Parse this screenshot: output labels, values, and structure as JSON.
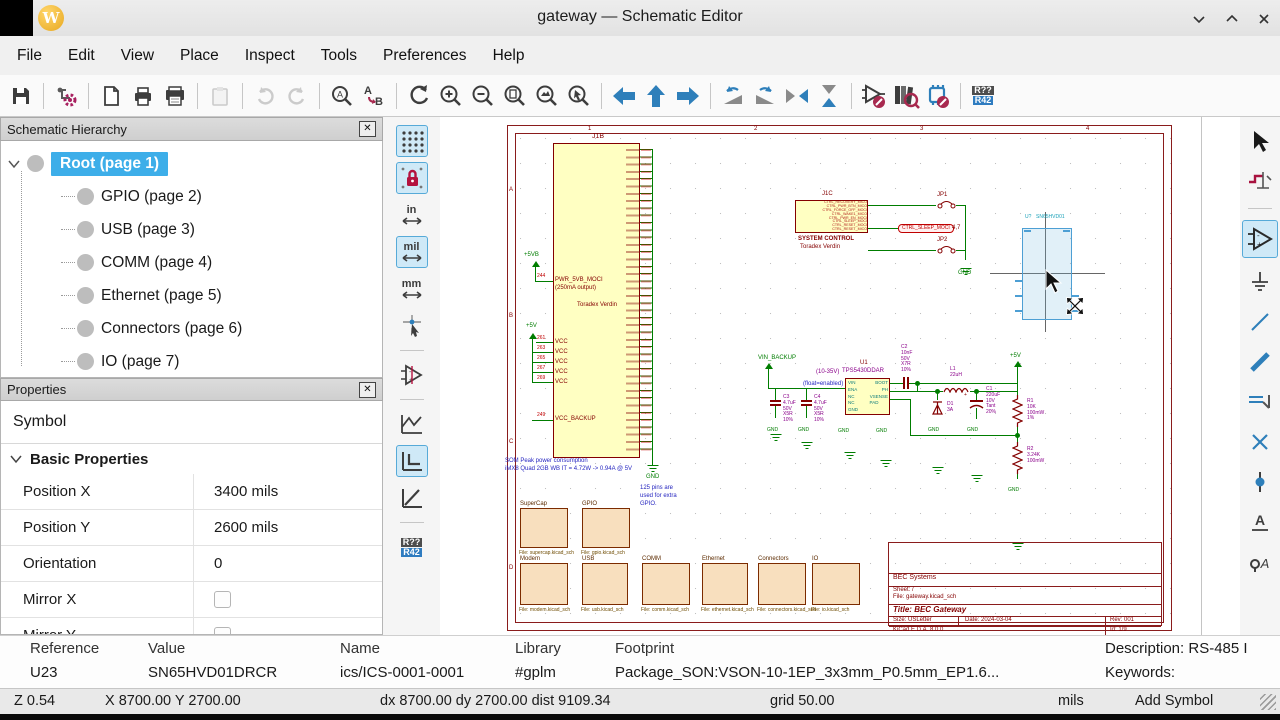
{
  "window": {
    "title": "gateway — Schematic Editor",
    "controls": [
      "chevron-down",
      "chevron-up",
      "close"
    ]
  },
  "menu": {
    "items": [
      "File",
      "Edit",
      "View",
      "Place",
      "Inspect",
      "Tools",
      "Preferences",
      "Help"
    ]
  },
  "toolbar_icons": [
    "save",
    "schematic-setup",
    "page-settings",
    "print",
    "plot",
    "paste",
    "undo",
    "redo",
    "find",
    "find-replace",
    "refresh-view",
    "zoom-in",
    "zoom-out",
    "zoom-fit",
    "zoom-objects",
    "zoom-selection",
    "nav-back",
    "nav-up",
    "nav-forward",
    "rotate-ccw",
    "rotate-cw",
    "mirror-horizontal",
    "mirror-vertical",
    "edit-symbol",
    "browse-libraries",
    "edit-footprint",
    "annotate"
  ],
  "annotate_icon": {
    "from": "R??",
    "to": "R42"
  },
  "hierarchy": {
    "title": "Schematic Hierarchy",
    "items": [
      {
        "label": "Root (page 1)",
        "selected": true
      },
      {
        "label": "GPIO (page 2)",
        "selected": false
      },
      {
        "label": "USB (page 3)",
        "selected": false
      },
      {
        "label": "COMM (page 4)",
        "selected": false
      },
      {
        "label": "Ethernet (page 5)",
        "selected": false
      },
      {
        "label": "Connectors (page 6)",
        "selected": false
      },
      {
        "label": "IO (page 7)",
        "selected": false
      }
    ]
  },
  "properties": {
    "title": "Properties",
    "subtitle": "Symbol",
    "section": "Basic Properties",
    "rows": [
      {
        "label": "Position X",
        "value": "3400 mils"
      },
      {
        "label": "Position Y",
        "value": "2600 mils"
      },
      {
        "label": "Orientation",
        "value": "0"
      },
      {
        "label": "Mirror X",
        "value": ""
      },
      {
        "label": "Mirror Y",
        "value": ""
      }
    ]
  },
  "left_toolbar": {
    "units": [
      "in",
      "mil",
      "mm"
    ]
  },
  "canvas": {
    "module": {
      "ref": "J1B",
      "name": "Toradex Verdin",
      "pwr_flag1": "+5VB",
      "pin244_num": "244",
      "pin244_name": "PWR_5VB_MOCI",
      "pin244_note": "(250mA output)",
      "pwr_flag2": "+5V",
      "vcc_pins": [
        {
          "num": "261",
          "name": "VCC"
        },
        {
          "num": "263",
          "name": "VCC"
        },
        {
          "num": "265",
          "name": "VCC"
        },
        {
          "num": "267",
          "name": "VCC"
        },
        {
          "num": "269",
          "name": "VCC"
        }
      ],
      "backup_num": "249",
      "backup_name": "VCC_BACKUP",
      "gnd": "GND"
    },
    "notes": {
      "som1": "SOM Peak power consumption",
      "som2": "iMX8 Quad 2GB WB IT = 4.72W -> 0.94A @ 5V",
      "gpio1": "125 pins are",
      "gpio2": "used for extra",
      "gpio3": "GPIO."
    },
    "sysctrl": {
      "ref": "J1C",
      "pins": [
        "CTRL_RECOVERY_MICO",
        "CTRL_PWR_BTN_MICO",
        "CTRL_FORCE_OFF_MOCI",
        "CTRL_WAKE1_MICO",
        "CTRL_PWR_EN_MOCI",
        "CTRL_SLEEP_MOCI",
        "CTRL_RESET_MOCI",
        "CTRL_RESET_MICO"
      ],
      "caption1": "SYSTEM CONTROL",
      "caption2": "Toradex Verdin",
      "jp1": "JP1",
      "jp2": "JP2",
      "netlabel": "CTRL_SLEEP_MOCI",
      "netlabel_pins": "4,7",
      "gnd": "GND"
    },
    "regulator": {
      "vin": "VIN_BACKUP",
      "range": "(10-35V)",
      "float_note": "(float=enabled)",
      "ref": "U1",
      "value": "TPS5430DDAR",
      "pins_left": [
        "VIN",
        "ENA",
        "NC",
        "NC",
        "GND"
      ],
      "pins_right": [
        "BOOT",
        "PH",
        "VSENSE",
        "PAD"
      ],
      "c2": [
        "C2",
        "10nF",
        "50V",
        "X7R",
        "10%"
      ],
      "c3": [
        "C3",
        "4.7uF",
        "50V",
        "X5R",
        "10%"
      ],
      "c4": [
        "C4",
        "4.7uF",
        "50V",
        "X5R",
        "10%"
      ],
      "l1": [
        "L1",
        "22uH"
      ],
      "d1": [
        "D1",
        "3A"
      ],
      "c1": [
        "C1",
        "220uF",
        "10V",
        "Tant",
        "20%"
      ],
      "r1": [
        "R1",
        "10K",
        "100mW",
        "1%"
      ],
      "r2": [
        "R2",
        "3.24K",
        "100mW"
      ],
      "out": "+5V",
      "gnd": "GND"
    },
    "sheets": {
      "row1": [
        {
          "name": "SuperCap",
          "file": "File: supercap.kicad_sch"
        },
        {
          "name": "GPIO",
          "file": "File: gpio.kicad_sch"
        }
      ],
      "row2": [
        {
          "name": "Modem",
          "file": "File: modem.kicad_sch"
        },
        {
          "name": "USB",
          "file": "File: usb.kicad_sch"
        },
        {
          "name": "COMM",
          "file": "File: comm.kicad_sch"
        },
        {
          "name": "Ethernet",
          "file": "File: ethernet.kicad_sch"
        },
        {
          "name": "Connectors",
          "file": "File: connectors.kicad_sch"
        },
        {
          "name": "IO",
          "file": "File: io.kicad_sch"
        }
      ]
    },
    "titleblock": {
      "company": "BEC Systems",
      "sheet": "Sheet: /",
      "file": "File: gateway.kicad_sch",
      "title": "Title: BEC Gateway",
      "size": "Size: USLetter",
      "date": "Date: 2024-03-04",
      "rev": "Rev: 001",
      "tool": "KiCad E.D.A. 8.0.0",
      "id": "Id: 1/9"
    },
    "ghost": {
      "ref": "U?",
      "value": "SN65HVD01"
    }
  },
  "status": {
    "fields": [
      {
        "label": "Reference",
        "value": "U23"
      },
      {
        "label": "Value",
        "value": "SN65HVD01DRCR"
      },
      {
        "label": "Name",
        "value": "ics/ICS-0001-0001"
      },
      {
        "label": "Library",
        "value": "#gplm"
      },
      {
        "label": "Footprint",
        "value": "Package_SON:VSON-10-1EP_3x3mm_P0.5mm_EP1.6..."
      }
    ],
    "description": "Description: RS-485 I",
    "keywords": "Keywords:",
    "zoom": "Z 0.54",
    "pos": "X 8700.00 Y 2700.00",
    "delta": "dx 8700.00 dy 2700.00 dist 9109.34",
    "grid": "grid 50.00",
    "units": "mils",
    "mode": "Add Symbol"
  },
  "colors": {
    "selection": "#3daee9",
    "active_tool_bg": "#cfe9f7",
    "wire_green": "#007d00",
    "symbol_fill": "#ffffc2",
    "symbol_outline": "#840000",
    "value_magenta": "#8a008a",
    "note_blue": "#2626c0",
    "sheet_fill": "#f8dfbe",
    "ghost_blue": "#4d9fd4"
  }
}
